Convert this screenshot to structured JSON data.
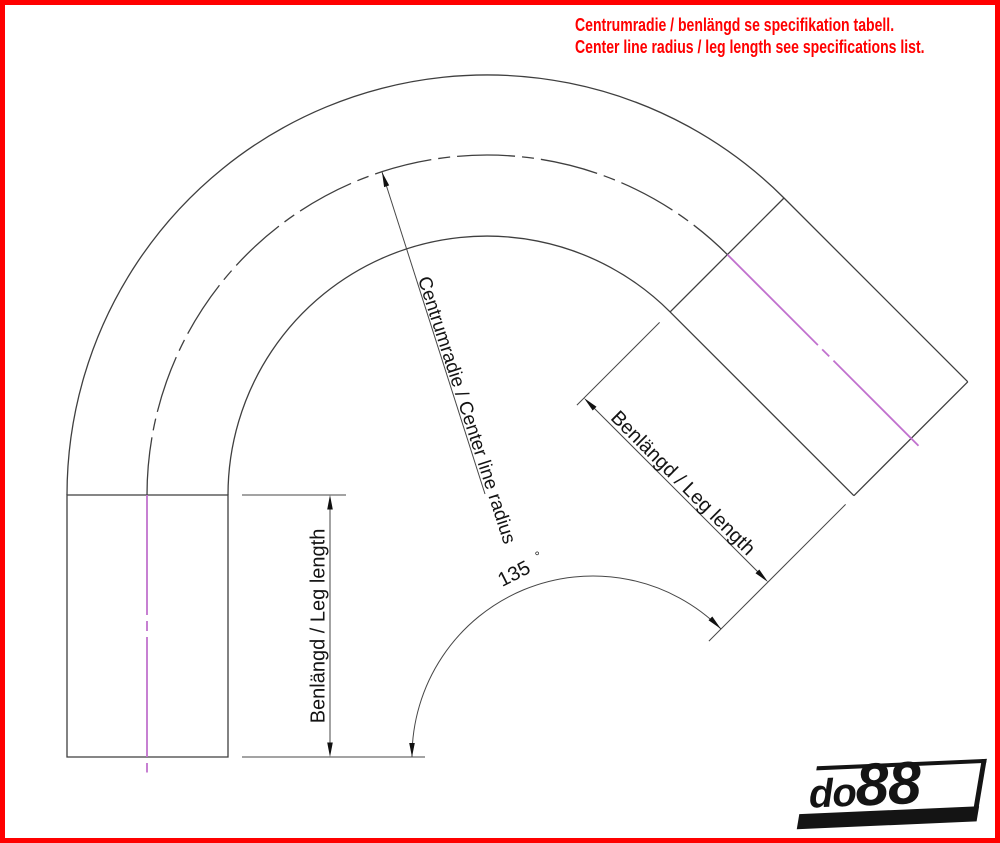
{
  "header": {
    "note_sv": "Centrumradie / benlängd se specifikation tabell.",
    "note_en": "Center line radius / leg length see specifications list.",
    "text_color": "#ff0000"
  },
  "drawing": {
    "type": "technical-diagram",
    "subject": "135 degree silicone hose bend, dimension drawing",
    "bend_angle_value": "135",
    "degree_symbol": "°",
    "center_radius_label": "Centrumradie / Center line radius",
    "left_leg_label": "Benlängd / Leg length",
    "right_leg_label": "Benlängd / Leg length",
    "outline_color": "#3f3f3f",
    "centerline_color": "#c172ce"
  },
  "logo": {
    "prefix": "do",
    "numbers": "88"
  },
  "border_color": "#ff0000"
}
